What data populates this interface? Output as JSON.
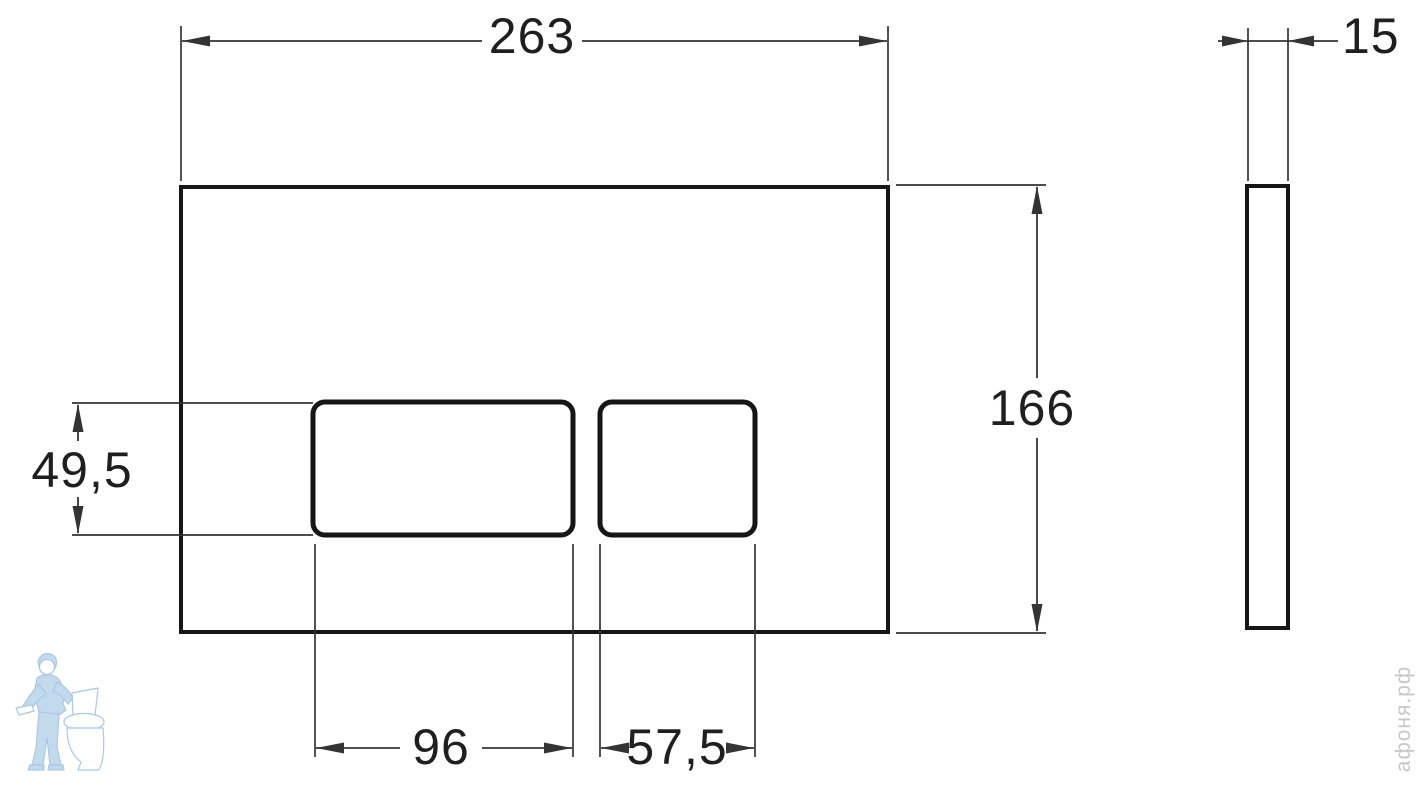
{
  "drawing": {
    "front_view": {
      "overall_width_mm": "263",
      "overall_height_mm": "166",
      "buttons_height_mm": "49,5",
      "large_button_width_mm": "96",
      "small_button_width_mm": "57,5"
    },
    "side_view": {
      "thickness_mm": "15"
    }
  },
  "watermark": {
    "brand_vertical_text": "афоня.рф",
    "logo_icon": "plumber-with-toilet-icon"
  },
  "colors": {
    "background": "#ffffff",
    "outline": "#161616",
    "dimension_lines": "#343434",
    "text": "#1f1f1f",
    "watermark_blue": "#bdd6ec",
    "watermark_gray": "#c7c7c7"
  }
}
